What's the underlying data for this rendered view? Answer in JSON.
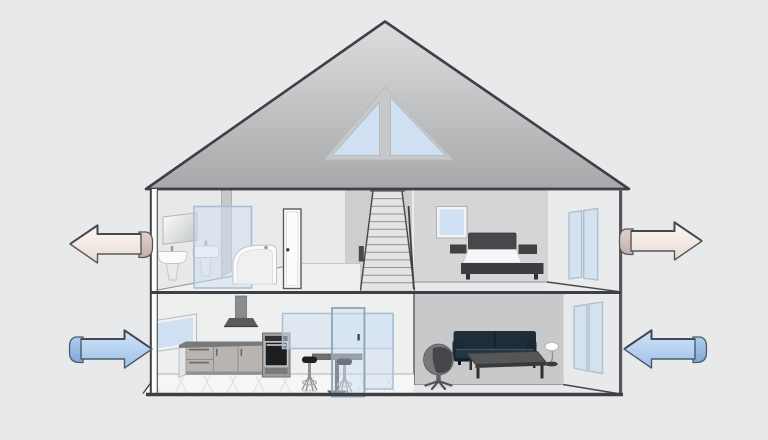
{
  "diagram": {
    "label": "Cutaway cross-section of a two-story house with attic showing ventilation airflow: stale air exhausted outward on the upper floor, fresh air supplied inward on the lower floor",
    "type": "house-ventilation-cutaway",
    "palette": {
      "background": "#e8e9ea",
      "outline": "#3e4043",
      "roof_top": "#dadbdc",
      "roof_bottom": "#a6a8aa",
      "glass": "#cfe0f2",
      "glass_frame": "#a9bed2",
      "glass_frame_soft": "#b5bfc7",
      "wall_light": "#e9eaeb",
      "wall_mid": "#d3d5d6",
      "wall_dark": "#c8c9cb",
      "exhaust_top": "#fdf8f5",
      "exhaust_bottom": "#eadad4",
      "exhaust_flap_top": "#e3d2cc",
      "exhaust_flap_bottom": "#bfafa9",
      "exhaust_stroke": "#55575a",
      "supply_top": "#d3e4f8",
      "supply_bottom": "#9cc1e8",
      "supply_flap_top": "#aecdef",
      "supply_flap_bottom": "#7da7d6",
      "supply_stroke": "#4e5a68"
    },
    "arrows": [
      {
        "name": "exhaust-arrow-upper-left",
        "airflow": "exhaust",
        "direction": "left",
        "floor": "upper",
        "side": "left",
        "color": "pale-pink"
      },
      {
        "name": "exhaust-arrow-upper-right",
        "airflow": "exhaust",
        "direction": "right",
        "floor": "upper",
        "side": "right",
        "color": "pale-pink"
      },
      {
        "name": "supply-arrow-lower-left",
        "airflow": "supply",
        "direction": "right",
        "floor": "lower",
        "side": "left",
        "color": "blue"
      },
      {
        "name": "supply-arrow-lower-right",
        "airflow": "supply",
        "direction": "left",
        "floor": "lower",
        "side": "right",
        "color": "blue"
      }
    ],
    "house": {
      "attic": {
        "features": [
          "triangular-gable-window-two-panes"
        ]
      },
      "upper_floor": {
        "rooms": [
          {
            "name": "bathroom",
            "items": [
              "wall-mirror",
              "pedestal-sink",
              "glass-shower-panel",
              "second-pedestal-sink",
              "corner-bathtub",
              "interior-door"
            ]
          },
          {
            "name": "hallway",
            "items": [
              "staircase",
              "stair-railing",
              "newel-post"
            ]
          },
          {
            "name": "bedroom",
            "items": [
              "window",
              "double-bed",
              "nightstand-left",
              "nightstand-right",
              "glass-balcony-doors"
            ]
          }
        ]
      },
      "lower_floor": {
        "rooms": [
          {
            "name": "kitchen",
            "items": [
              "side-window",
              "range-hood",
              "base-cabinets",
              "tall-oven",
              "glass-partition",
              "glass-door",
              "bar-table",
              "bar-stool",
              "bar-stool",
              "tiled-floor"
            ]
          },
          {
            "name": "living-room",
            "items": [
              "egg-chair",
              "sofa",
              "coffee-table",
              "floor-lamp",
              "glass-patio-doors"
            ]
          }
        ]
      }
    }
  }
}
